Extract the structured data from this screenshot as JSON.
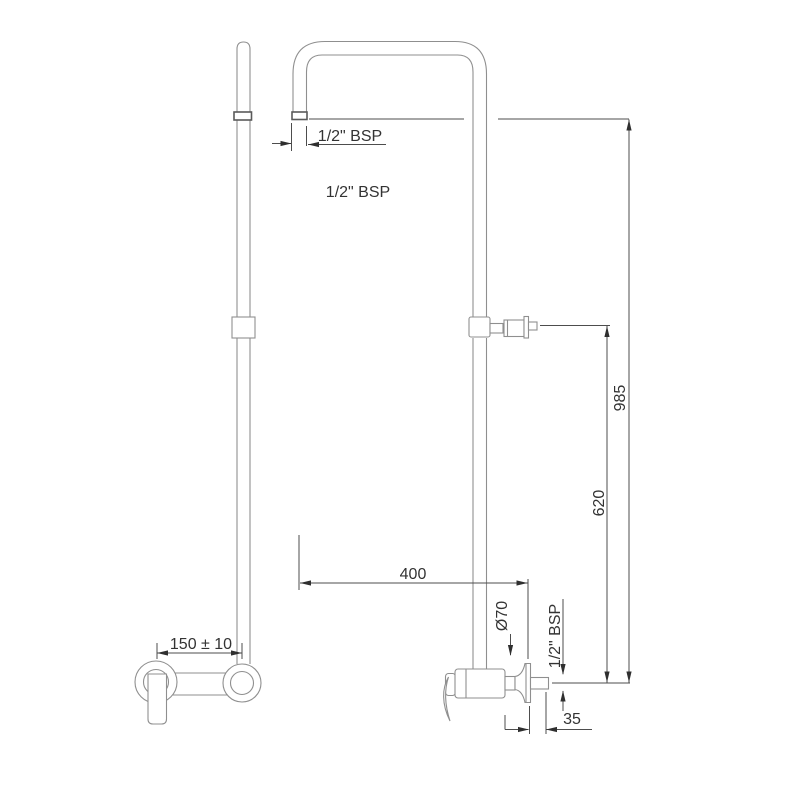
{
  "drawing": {
    "kind": "technical-dimension-drawing",
    "units": "mm",
    "colors": {
      "background": "#ffffff",
      "outline": "#8f8f8f",
      "dimension_line": "#4d4d4d",
      "arrow": "#2f2f2f",
      "text": "#333333"
    },
    "labels": [
      {
        "id": "spout-thread-callout",
        "text": "1/2\" BSP",
        "orientation": "horizontal"
      },
      {
        "id": "riser-thread-label",
        "text": "1/2\" BSP",
        "orientation": "horizontal"
      },
      {
        "id": "overall-height",
        "text": "985",
        "orientation": "vertical"
      },
      {
        "id": "bracket-height",
        "text": "620",
        "orientation": "vertical"
      },
      {
        "id": "spout-reach",
        "text": "400",
        "orientation": "horizontal"
      },
      {
        "id": "flange-diameter",
        "text": "Ø70",
        "orientation": "vertical"
      },
      {
        "id": "outlet-thread",
        "text": "1/2\" BSP",
        "orientation": "vertical"
      },
      {
        "id": "wall-projection",
        "text": "35",
        "orientation": "horizontal"
      },
      {
        "id": "inlet-centres",
        "text": "150 ± 10",
        "orientation": "horizontal"
      }
    ]
  }
}
